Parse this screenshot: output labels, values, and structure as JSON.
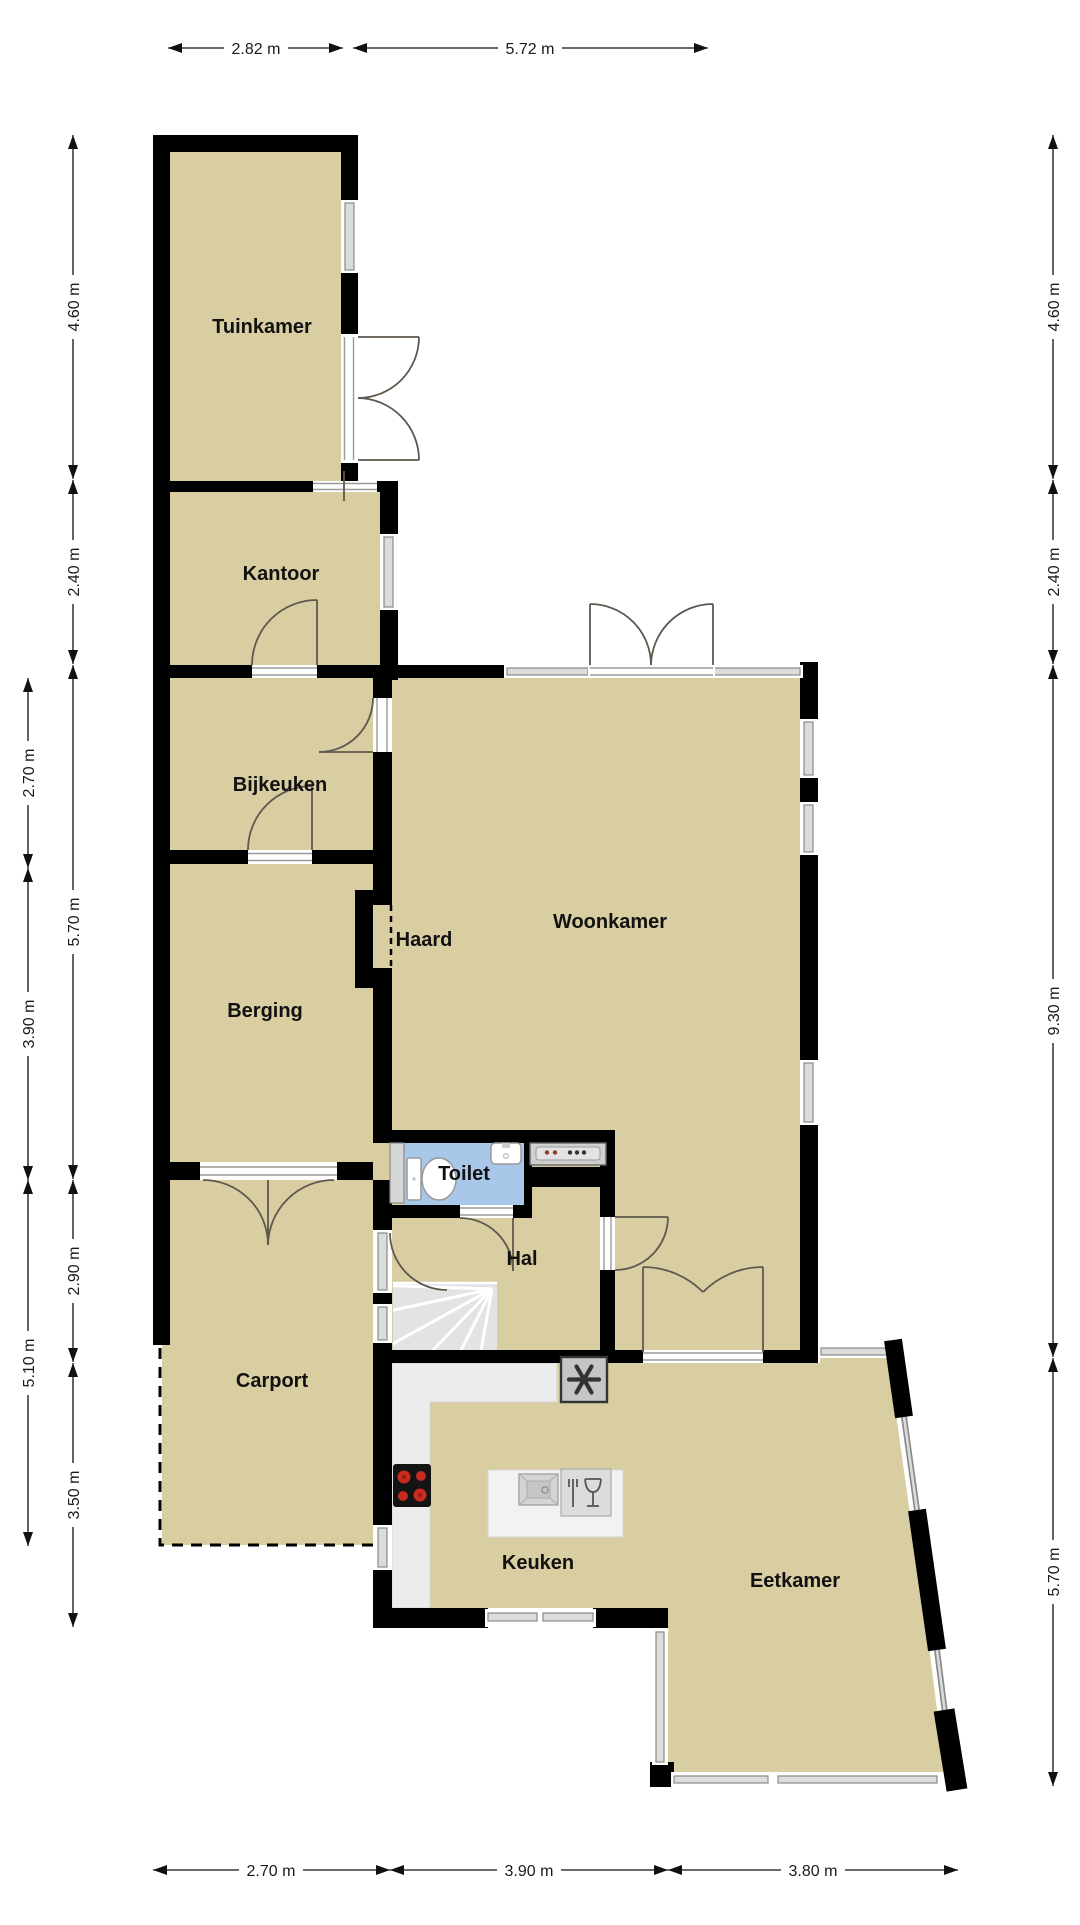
{
  "floorplan": {
    "rooms": {
      "tuinkamer": {
        "label": "Tuinkamer"
      },
      "kantoor": {
        "label": "Kantoor"
      },
      "bijkeuken": {
        "label": "Bijkeuken"
      },
      "berging": {
        "label": "Berging"
      },
      "haard": {
        "label": "Haard"
      },
      "woonkamer": {
        "label": "Woonkamer"
      },
      "toilet": {
        "label": "Toilet"
      },
      "hal": {
        "label": "Hal"
      },
      "carport": {
        "label": "Carport"
      },
      "keuken": {
        "label": "Keuken"
      },
      "eetkamer": {
        "label": "Eetkamer"
      }
    },
    "dimensions": {
      "top": [
        "2.82 m",
        "5.72 m"
      ],
      "bottom": [
        "2.70 m",
        "3.90 m",
        "3.80 m"
      ],
      "left_outer": [
        "2.70 m",
        "3.90 m",
        "5.10 m"
      ],
      "left_inner": [
        "4.60 m",
        "2.40 m",
        "5.70 m",
        "2.90 m",
        "3.50 m"
      ],
      "right": [
        "4.60 m",
        "2.40 m",
        "9.30 m",
        "5.70 m"
      ]
    },
    "fixtures": {
      "toilet_icon": "toilet-top-view",
      "washbasin_icon": "washbasin-icon",
      "cabinet_icon": "cabinet-icon",
      "appliance_icon": "appliance-counter-icon",
      "stairs_icon": "winder-stairs-icon",
      "stove_icon": "cooktop-4-burner-icon",
      "island_sink_icon": "kitchen-sink-icon",
      "dishwasher_icon": "fork-and-glass-icon",
      "vent_icon": "fan-asterisk-icon",
      "fireplace_icon": "fireplace-dashed-icon"
    },
    "colors": {
      "floor": "#d9cda2",
      "wall": "#000000",
      "toilet": "#a9c7e9",
      "glass": "#dcdcdc",
      "counter": "#ececec",
      "stairs": "#e3e3e3",
      "arc": "#5f584e",
      "burner": "#c72b1e"
    }
  }
}
